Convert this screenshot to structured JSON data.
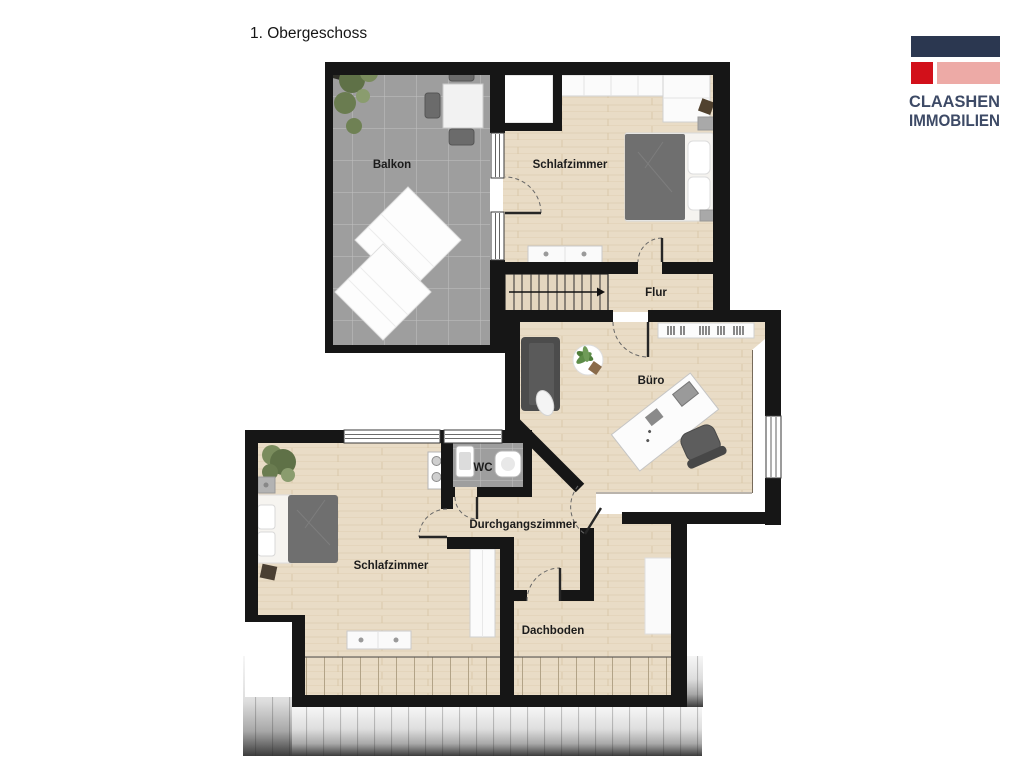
{
  "page": {
    "title": "1. Obergeschoss"
  },
  "logo": {
    "line1": "CLAASHEN",
    "line2": "IMMOBILIEN",
    "colors": {
      "navy": "#2b3750",
      "red": "#d2101a",
      "pink": "#edaaa6",
      "text": "#3d4a66"
    }
  },
  "floorplan": {
    "colors": {
      "wall": "#161616",
      "wood": "#e9dcc6",
      "tile": "#9e9e9e",
      "label": "#1c1c1c"
    },
    "rooms": {
      "balkon": {
        "label": "Balkon"
      },
      "schlafzimmer_oben": {
        "label": "Schlafzimmer"
      },
      "flur": {
        "label": "Flur"
      },
      "buero": {
        "label": "Büro"
      },
      "wc": {
        "label": "WC"
      },
      "durchgangszimmer": {
        "label": "Durchgangszimmer"
      },
      "schlafzimmer_unten": {
        "label": "Schlafzimmer"
      },
      "dachboden": {
        "label": "Dachboden"
      }
    }
  }
}
